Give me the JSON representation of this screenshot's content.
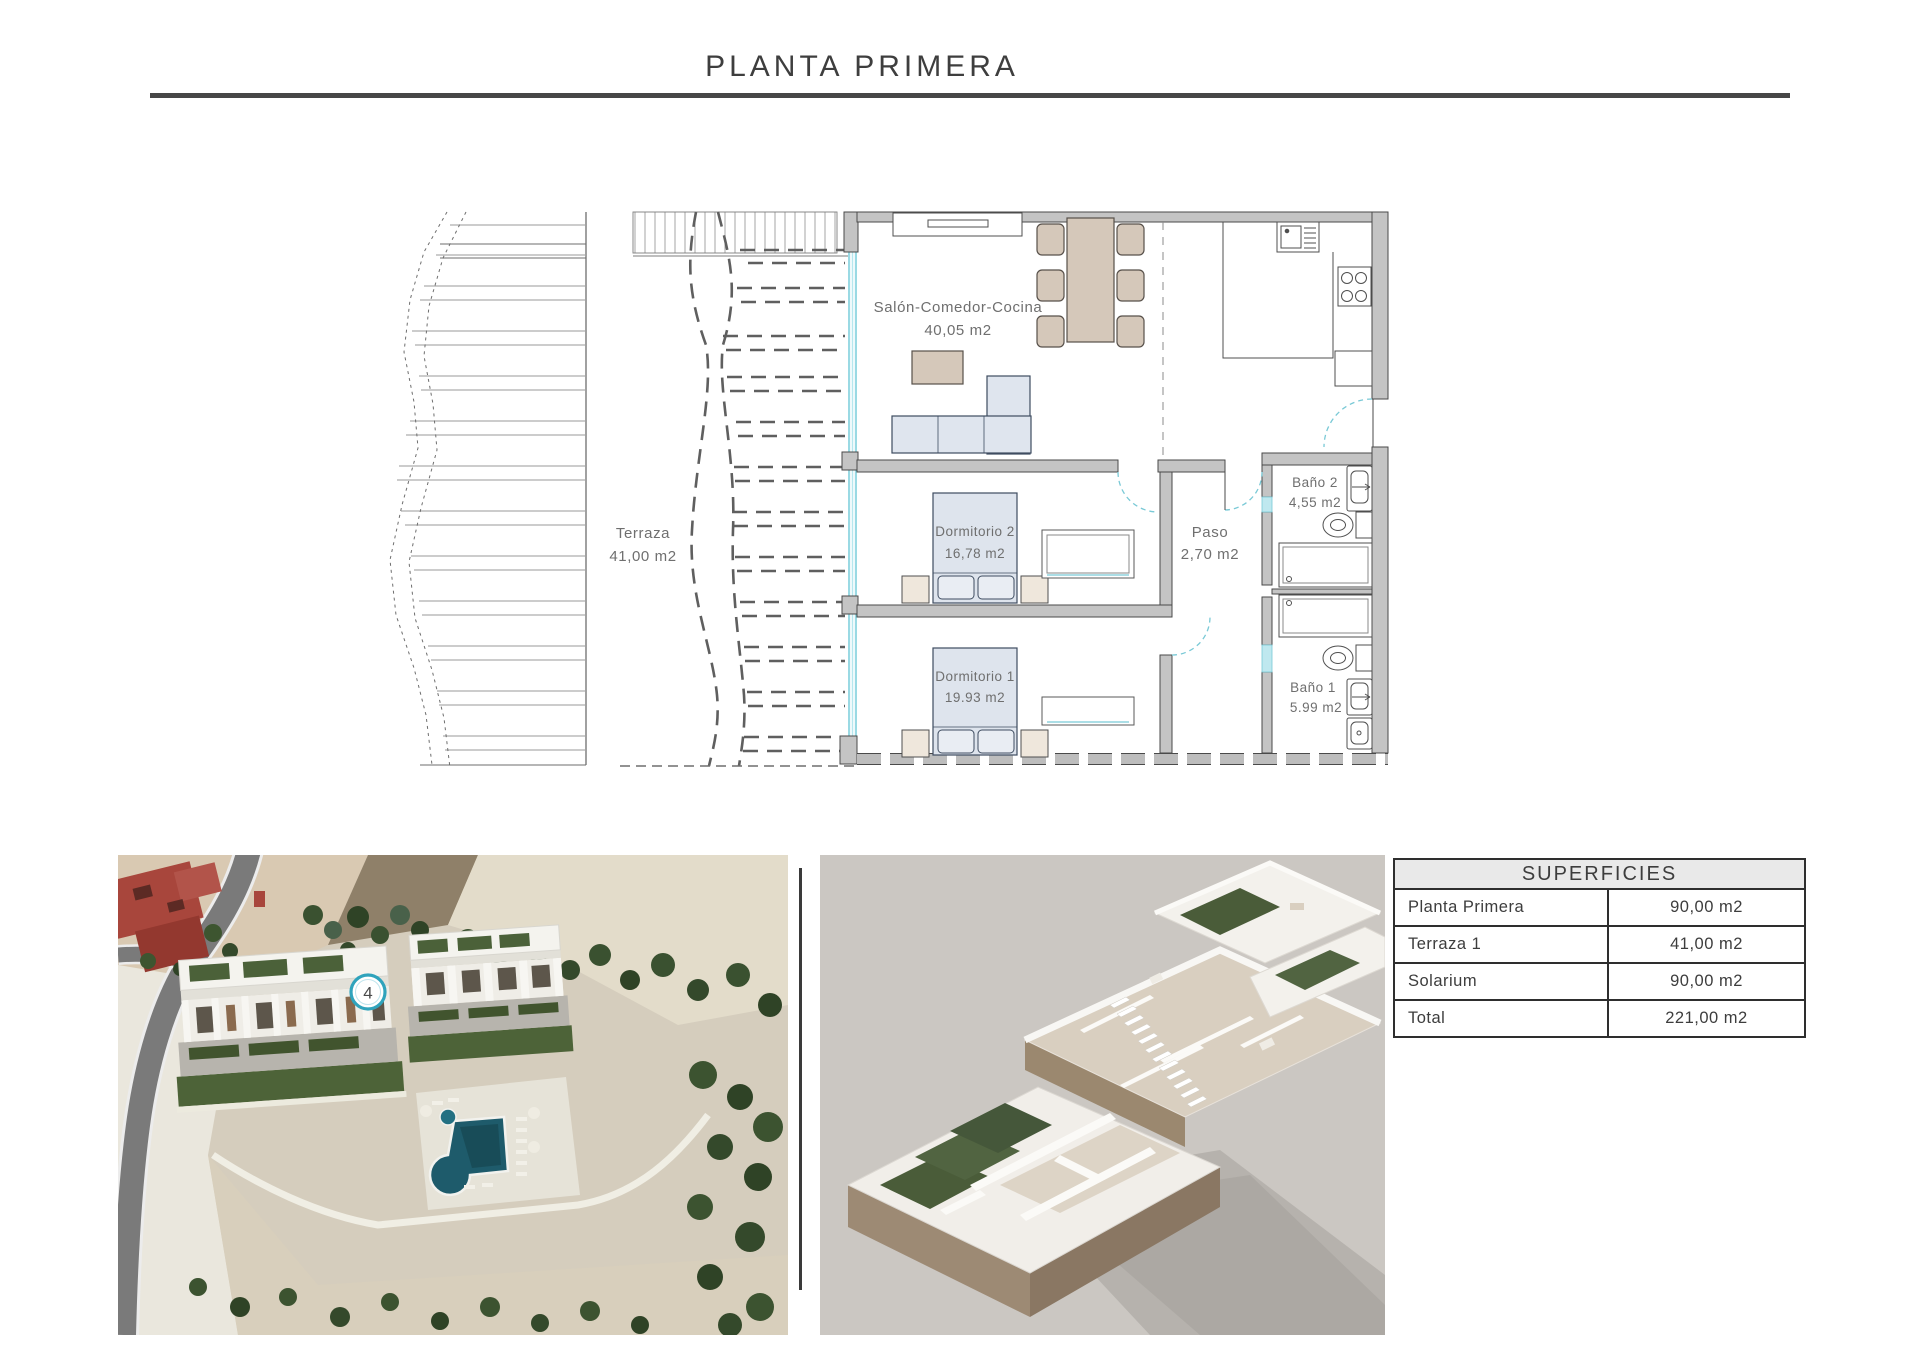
{
  "title": "PLANTA PRIMERA",
  "plan": {
    "terraza": {
      "name": "Terraza",
      "area": "41,00 m2"
    },
    "salon": {
      "name": "Salón-Comedor-Cocina",
      "area": "40,05 m2"
    },
    "dorm2": {
      "name": "Dormitorio 2",
      "area": "16,78 m2"
    },
    "dorm1": {
      "name": "Dormitorio 1",
      "area": "19.93 m2"
    },
    "paso": {
      "name": "Paso",
      "area": "2,70 m2"
    },
    "bano2": {
      "name": "Baño 2",
      "area": "4,55 m2"
    },
    "bano1": {
      "name": "Baño 1",
      "area": "5.99 m2"
    }
  },
  "photo": {
    "unit_badge": "4"
  },
  "superficies": {
    "header": "SUPERFICIES",
    "rows": [
      {
        "label": "Planta Primera",
        "value": "90,00 m2"
      },
      {
        "label": "Terraza 1",
        "value": "41,00 m2"
      },
      {
        "label": "Solarium",
        "value": "90,00 m2"
      },
      {
        "label": "Total",
        "value": "221,00 m2"
      }
    ]
  },
  "colors": {
    "wall_gray": "#c4c4c4",
    "glass_cyan": "#76ccd9",
    "furniture_tan": "#d5c8ba",
    "upholstery_blue": "#dfe5ee",
    "pool_teal": "#1e5b6b",
    "badge_ring": "#2fa3bc",
    "rule_dark": "#474747"
  }
}
